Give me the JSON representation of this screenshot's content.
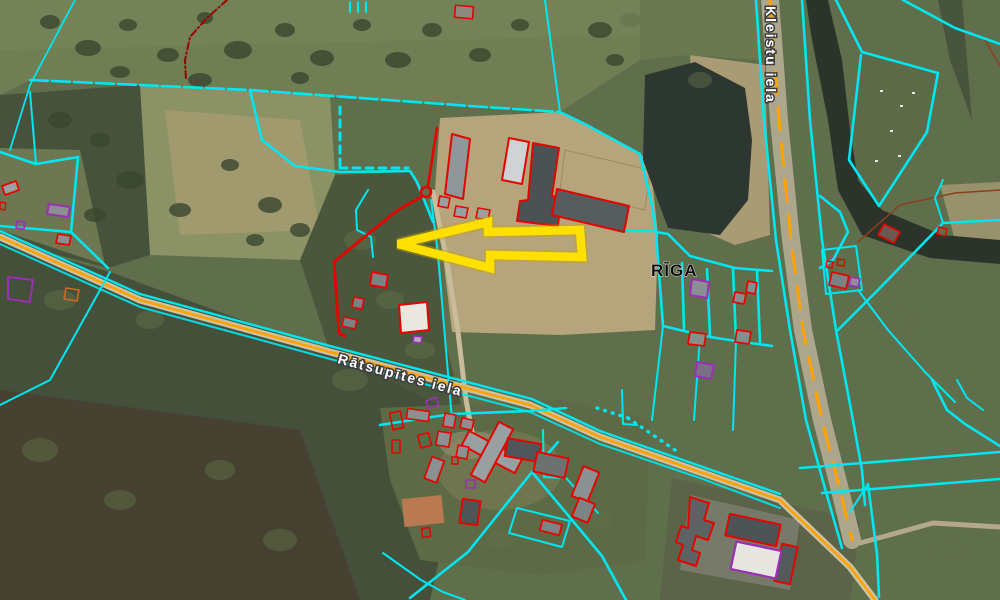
{
  "map": {
    "type": "cadastral-parcel-map-over-aerial-photo",
    "labels": {
      "city": "RĪGA",
      "street_main": "Rātsupītes iela",
      "street_cross": "Kleistu iela"
    },
    "legend_colors": {
      "parcel_boundary": "#00E6F2",
      "building_outline": "#E10600",
      "annotation_outline": "#9B2FB5",
      "road_centerline": "#FFA200",
      "highlight_arrow": "#FFE000",
      "highlighted_parcel": "#E10600"
    },
    "annotations": {
      "arrow": {
        "shape": "left-pointing-outline-arrow",
        "color": "#FFE000"
      }
    }
  }
}
